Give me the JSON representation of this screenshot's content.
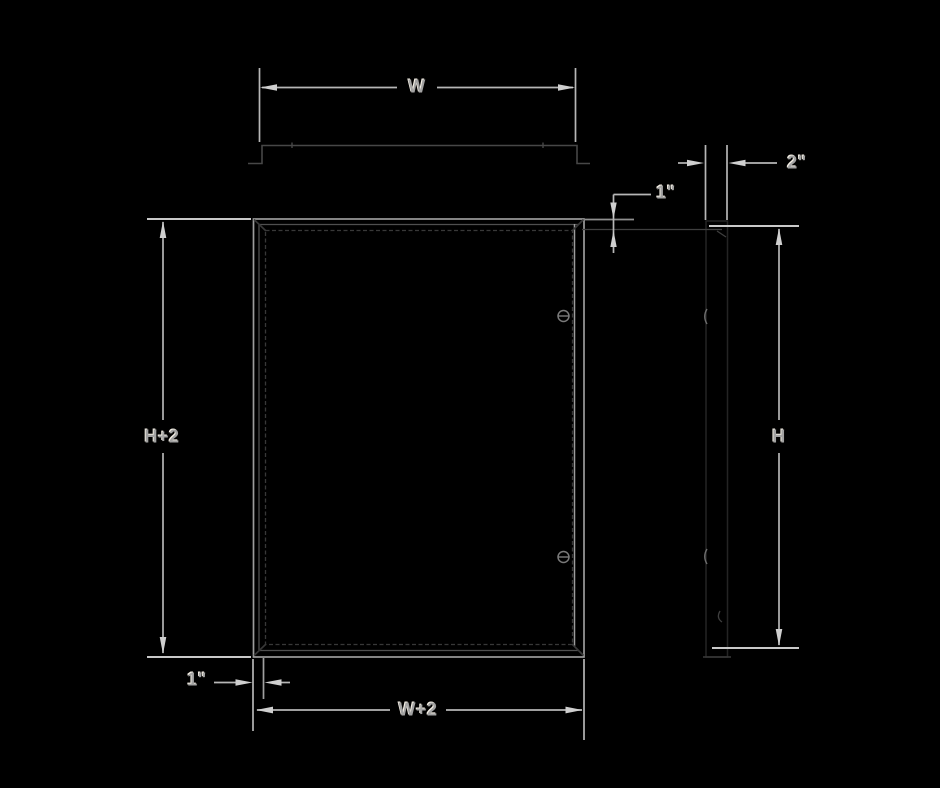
{
  "drawing": {
    "description": "Access door frame technical drawing, front view and side profile with dimension callouts",
    "labels": {
      "width": "W",
      "height": "H",
      "width_plus_two": "W+2",
      "height_plus_two": "H+2",
      "flange_top": "1\"",
      "flange_bottom": "1\"",
      "depth": "2\""
    },
    "colors": {
      "background": "#000000",
      "dimension_line": "#b6b6b6",
      "bright_extension_line": "#c9c9c9",
      "arrowhead": "#cfcfcf",
      "label_text": "#a2a2a2",
      "label_highlight": "#f3eee4",
      "frame_outline": "#9c9c9c",
      "inner_frame_outline": "#4f4f4f",
      "flange_outline": "#474747",
      "door_panel_outline": "#383838",
      "screw_head": "#7a7a7a",
      "side_profile_outline": "#242424",
      "side_latch_mark": "#6e6e6e"
    }
  }
}
